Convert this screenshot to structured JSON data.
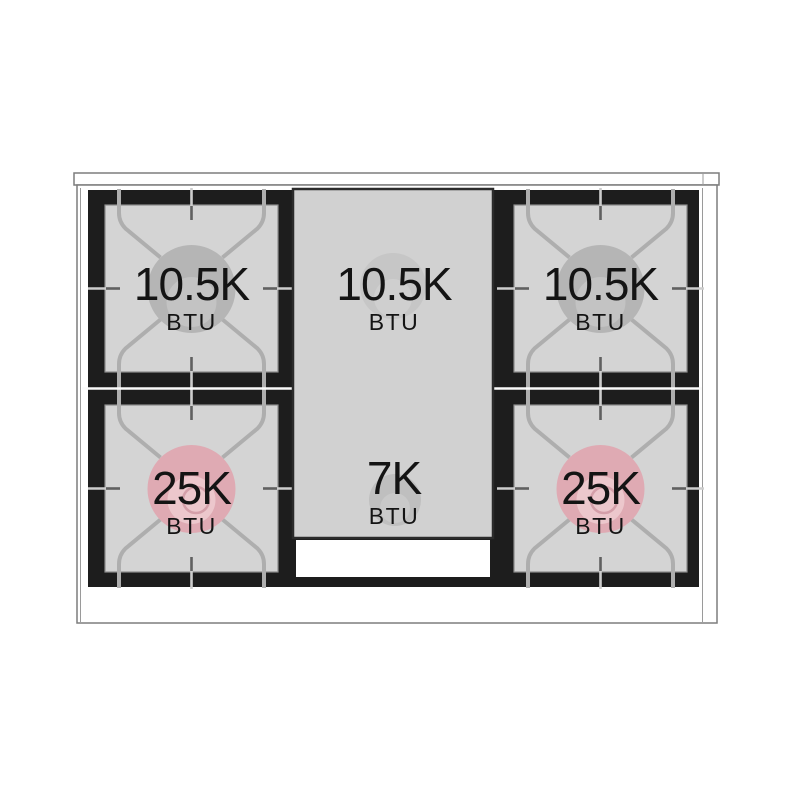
{
  "burners": [
    {
      "position": "top-left",
      "value": "10.5K",
      "unit": "BTU",
      "burner_color": "#b5b5b5",
      "cap_color": "#c3c3c3"
    },
    {
      "position": "top-center",
      "value": "10.5K",
      "unit": "BTU",
      "burner_color": "#c6c6c6",
      "cap_color": "#cfcfcf"
    },
    {
      "position": "top-right",
      "value": "10.5K",
      "unit": "BTU",
      "burner_color": "#b5b5b5",
      "cap_color": "#c3c3c3"
    },
    {
      "position": "bottom-left",
      "value": "25K",
      "unit": "BTU",
      "burner_color": "#dfaab3",
      "cap_color": "#ecc7cc"
    },
    {
      "position": "bottom-center",
      "value": "7K",
      "unit": "BTU",
      "burner_color": "#bfbfbf",
      "cap_color": "#c9c9c9"
    },
    {
      "position": "bottom-right",
      "value": "25K",
      "unit": "BTU",
      "burner_color": "#dfaab3",
      "cap_color": "#ecc7cc"
    }
  ],
  "colors": {
    "panel_black": "#1d1d1d",
    "surface_gray": "#d4d4d4",
    "griddle_gray": "#d1d1d1",
    "high_power_pink": "#dfaab3",
    "text": "#141414"
  }
}
